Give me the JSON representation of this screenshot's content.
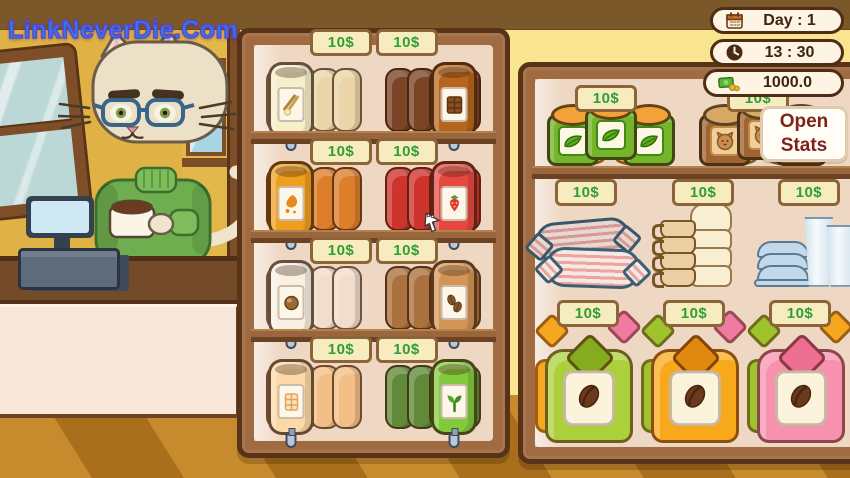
{
  "watermark": "LinkNeverDie.Com",
  "hud": {
    "day_label": "Day : 1",
    "time_label": "13 : 30",
    "money_label": "1000.0",
    "open_stats_line1": "Open",
    "open_stats_line2": "Stats"
  },
  "left_shelf": {
    "rows": [
      {
        "left": {
          "product": "vanilla syrup dispenser",
          "price": "10$",
          "body": "#ead6a8",
          "front": "#f7eecb",
          "icon": "vanilla"
        },
        "right": {
          "product": "chocolate syrup dispenser",
          "price": "10$",
          "body": "#7c4426",
          "front": "#b5661c",
          "icon": "chocolate"
        }
      },
      {
        "left": {
          "product": "caramel syrup dispenser",
          "price": "10$",
          "body": "#dd7e2a",
          "front": "#ef9f1e",
          "icon": "caramel"
        },
        "right": {
          "product": "strawberry syrup dispenser",
          "price": "10$",
          "body": "#ce342c",
          "front": "#e64840",
          "icon": "strawberry"
        }
      },
      {
        "left": {
          "product": "coconut syrup dispenser",
          "price": "10$",
          "body": "#f2ddca",
          "front": "#faf0e2",
          "icon": "nut"
        },
        "right": {
          "product": "coffee syrup dispenser",
          "price": "10$",
          "body": "#ab713e",
          "front": "#d29556",
          "icon": "beans"
        }
      },
      {
        "left": {
          "product": "white chocolate syrup dispenser",
          "price": "10$",
          "body": "#f4bf86",
          "front": "#fcd9a6",
          "icon": "white-chocolate"
        },
        "right": {
          "product": "matcha syrup dispenser",
          "price": "10$",
          "body": "#61893a",
          "front": "#82c93e",
          "icon": "sprout"
        }
      }
    ]
  },
  "right_shelf": {
    "rows": [
      {
        "groups": [
          {
            "product": "green tea jars",
            "price": "10$",
            "body": "#76b42c",
            "lid": "#f2a238",
            "label_border": "#3e8a14",
            "label_bg": "#fdf8e4",
            "icon": "tea-leaf"
          },
          {
            "product": "cat treat jars",
            "price": "10$",
            "body": "#a06432",
            "lid": "#d8a865",
            "label_border": "#c08a4a",
            "label_bg": "#f2cf9a",
            "icon": "cat"
          }
        ]
      },
      {
        "groups": [
          {
            "product": "straw packs",
            "price": "10$"
          },
          {
            "product": "mugs and ceramic cups",
            "price": "10$"
          },
          {
            "product": "lids and plastic cups",
            "price": "10$"
          }
        ]
      },
      {
        "groups": [
          {
            "product": "coffee bean bag green",
            "price": "10$",
            "body": "#abd03c",
            "accent": "#84ac1e",
            "backs": [
              "#f5a81f",
              "#f07ba0"
            ],
            "icon": "bean"
          },
          {
            "product": "coffee bean bag orange",
            "price": "10$",
            "body": "#f7a81b",
            "accent": "#e0890e",
            "backs": [
              "#9ec32c",
              "#f07ba0"
            ],
            "icon": "bean"
          },
          {
            "product": "coffee bean bag pink",
            "price": "10$",
            "body": "#f792ae",
            "accent": "#ef6f94",
            "backs": [
              "#9ec32c",
              "#f5a81f"
            ],
            "icon": "bean"
          }
        ]
      }
    ]
  },
  "edge_rack": {
    "items": [
      {
        "body": "#8cc63f",
        "lid": "#f29c38"
      },
      {
        "body": "#e8b56a",
        "lid": "#e05a7a"
      },
      {
        "body": "#89b84a",
        "lid": "#f2c94c"
      },
      {
        "body": "#f0a0b8",
        "lid": "#d94f6e"
      },
      {
        "body": "#d9a968",
        "lid": "#8cc63f"
      }
    ]
  }
}
